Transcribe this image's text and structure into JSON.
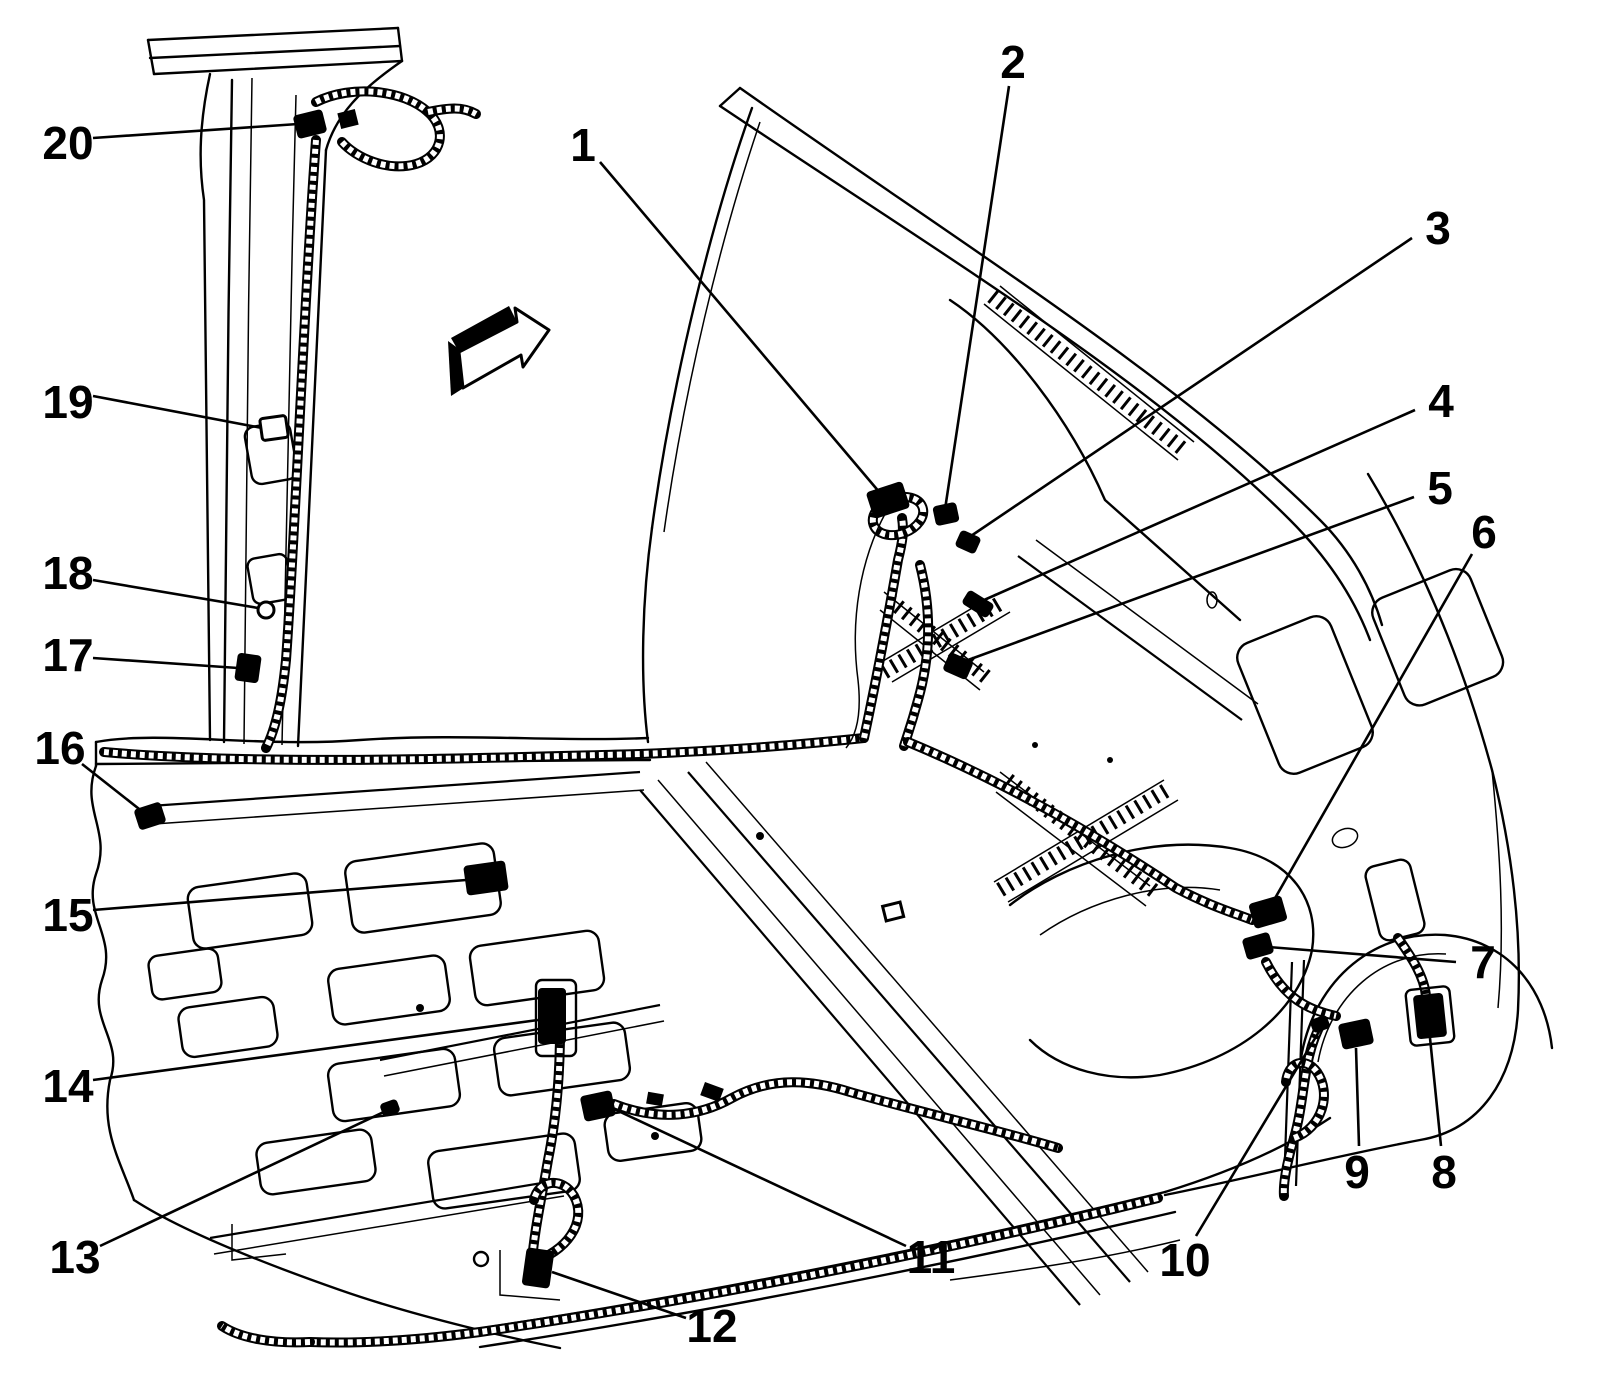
{
  "figure": {
    "line_color": "#000000",
    "background_color": "#ffffff",
    "direction_arrow": {
      "icon": "direction-arrow-icon",
      "x": 448,
      "y": 306
    }
  },
  "callouts": [
    {
      "number": "1",
      "label_x": 583,
      "label_y": 145,
      "attach_x": 600,
      "attach_y": 162,
      "target_x": 886,
      "target_y": 500,
      "connector": {
        "cx": 888,
        "cy": 500,
        "w": 36,
        "h": 26,
        "rot": -18
      }
    },
    {
      "number": "2",
      "label_x": 1013,
      "label_y": 62,
      "attach_x": 1009,
      "attach_y": 86,
      "target_x": 944,
      "target_y": 516,
      "connector": {
        "cx": 946,
        "cy": 514,
        "w": 22,
        "h": 18,
        "rot": -12
      }
    },
    {
      "number": "3",
      "label_x": 1438,
      "label_y": 228,
      "attach_x": 1412,
      "attach_y": 238,
      "target_x": 965,
      "target_y": 540,
      "connector": {
        "cx": 968,
        "cy": 542,
        "w": 20,
        "h": 16,
        "rot": 24
      }
    },
    {
      "number": "4",
      "label_x": 1441,
      "label_y": 401,
      "attach_x": 1415,
      "attach_y": 410,
      "target_x": 975,
      "target_y": 604,
      "connector": {
        "cx": 978,
        "cy": 604,
        "w": 28,
        "h": 14,
        "rot": 32
      }
    },
    {
      "number": "5",
      "label_x": 1440,
      "label_y": 488,
      "attach_x": 1414,
      "attach_y": 497,
      "target_x": 957,
      "target_y": 664,
      "connector": {
        "cx": 958,
        "cy": 666,
        "w": 24,
        "h": 18,
        "rot": 24
      }
    },
    {
      "number": "6",
      "label_x": 1484,
      "label_y": 532,
      "attach_x": 1472,
      "attach_y": 554,
      "target_x": 1266,
      "target_y": 914,
      "connector": {
        "cx": 1268,
        "cy": 912,
        "w": 32,
        "h": 24,
        "rot": -16
      }
    },
    {
      "number": "7",
      "label_x": 1483,
      "label_y": 962,
      "attach_x": 1456,
      "attach_y": 962,
      "target_x": 1256,
      "target_y": 946,
      "connector": {
        "cx": 1258,
        "cy": 946,
        "w": 26,
        "h": 20,
        "rot": -16
      }
    },
    {
      "number": "8",
      "label_x": 1444,
      "label_y": 1172,
      "attach_x": 1441,
      "attach_y": 1146,
      "target_x": 1430,
      "target_y": 1038,
      "connector": {
        "cx": 1430,
        "cy": 1016,
        "w": 28,
        "h": 42,
        "rot": -6
      }
    },
    {
      "number": "9",
      "label_x": 1357,
      "label_y": 1172,
      "attach_x": 1359,
      "attach_y": 1146,
      "target_x": 1356,
      "target_y": 1048,
      "connector": {
        "cx": 1356,
        "cy": 1034,
        "w": 30,
        "h": 24,
        "rot": -12
      }
    },
    {
      "number": "10",
      "label_x": 1185,
      "label_y": 1260,
      "attach_x": 1196,
      "attach_y": 1236,
      "target_x": 1320,
      "target_y": 1030,
      "connector": {
        "cx": 1320,
        "cy": 1024,
        "w": 16,
        "h": 12,
        "rot": -20
      }
    },
    {
      "number": "11",
      "label_x": 931,
      "label_y": 1257,
      "attach_x": 906,
      "attach_y": 1246,
      "target_x": 612,
      "target_y": 1108,
      "connector": {
        "cx": 598,
        "cy": 1106,
        "w": 30,
        "h": 24,
        "rot": -12
      }
    },
    {
      "number": "12",
      "label_x": 712,
      "label_y": 1326,
      "attach_x": 686,
      "attach_y": 1318,
      "target_x": 552,
      "target_y": 1272,
      "connector": {
        "cx": 538,
        "cy": 1268,
        "w": 26,
        "h": 36,
        "rot": 8
      }
    },
    {
      "number": "13",
      "label_x": 75,
      "label_y": 1257,
      "attach_x": 100,
      "attach_y": 1246,
      "target_x": 388,
      "target_y": 1110,
      "connector": {
        "cx": 390,
        "cy": 1108,
        "w": 16,
        "h": 12,
        "rot": -20
      }
    },
    {
      "number": "14",
      "label_x": 68,
      "label_y": 1086,
      "attach_x": 93,
      "attach_y": 1080,
      "target_x": 538,
      "target_y": 1020,
      "connector": {
        "cx": 552,
        "cy": 1016,
        "w": 26,
        "h": 54,
        "rot": 0
      }
    },
    {
      "number": "15",
      "label_x": 68,
      "label_y": 915,
      "attach_x": 93,
      "attach_y": 910,
      "target_x": 466,
      "target_y": 880,
      "connector": {
        "cx": 486,
        "cy": 878,
        "w": 40,
        "h": 28,
        "rot": -8
      }
    },
    {
      "number": "16",
      "label_x": 60,
      "label_y": 748,
      "attach_x": 82,
      "attach_y": 764,
      "target_x": 148,
      "target_y": 816,
      "connector": {
        "cx": 150,
        "cy": 816,
        "w": 26,
        "h": 20,
        "rot": -18
      }
    },
    {
      "number": "17",
      "label_x": 68,
      "label_y": 655,
      "attach_x": 93,
      "attach_y": 658,
      "target_x": 238,
      "target_y": 668,
      "connector": {
        "cx": 248,
        "cy": 668,
        "w": 22,
        "h": 26,
        "rot": 8
      }
    },
    {
      "number": "18",
      "label_x": 68,
      "label_y": 573,
      "attach_x": 93,
      "attach_y": 580,
      "target_x": 258,
      "target_y": 608,
      "connector": {
        "cx": 266,
        "cy": 610,
        "shape": "circle",
        "r": 8,
        "style": "outline"
      }
    },
    {
      "number": "19",
      "label_x": 68,
      "label_y": 402,
      "attach_x": 93,
      "attach_y": 396,
      "target_x": 262,
      "target_y": 428,
      "connector": {
        "cx": 274,
        "cy": 428,
        "w": 26,
        "h": 22,
        "rot": -8,
        "style": "outline"
      }
    },
    {
      "number": "20",
      "label_x": 68,
      "label_y": 143,
      "attach_x": 93,
      "attach_y": 138,
      "target_x": 298,
      "target_y": 124,
      "connector": {
        "cx": 310,
        "cy": 124,
        "w": 28,
        "h": 22,
        "rot": -14
      }
    }
  ]
}
